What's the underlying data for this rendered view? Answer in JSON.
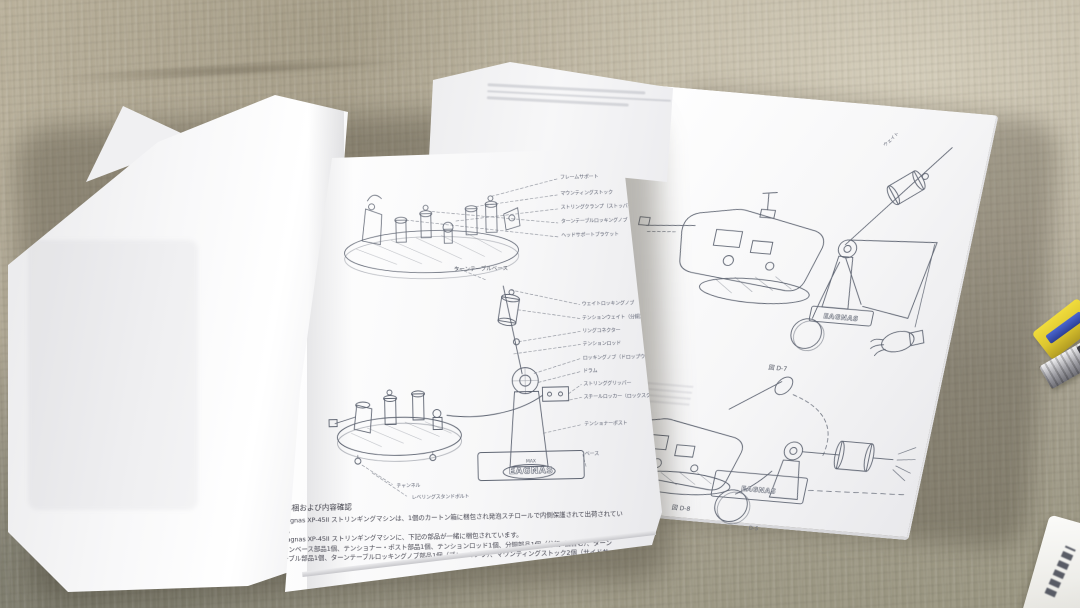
{
  "scene": {
    "type": "photo",
    "subject": "Japanese instruction manual pages for an Eagnas XP-45II stringing machine laid on a carpet",
    "colors": {
      "carpet_light": "#c6bfab",
      "carpet_mid": "#b0a996",
      "carpet_dark": "#8f8c7b",
      "paper": "#f6f6f7",
      "line_ink": "#4a5160",
      "text_ink": "#474752",
      "tool_yellow": "#e4cf35",
      "tool_blue": "#3a55c0",
      "metal_gray": "#9a9aa0"
    }
  },
  "left_page": {
    "diagram_base": {
      "caption": "ターンテーブルベース",
      "callouts": [
        "フレームサポート",
        "マウンティングストック",
        "ストリングクランプ（ストッパー付）",
        "ターンテーブルロッキングノブ",
        "ヘッドサポートブラケット"
      ]
    },
    "diagram_machine": {
      "logo": "EAGNAS",
      "logo_mark": "MAX",
      "callouts": [
        "ウェイトロッキングノブ",
        "テンションウェイト（分銅）",
        "リングコネクター",
        "テンションロッド",
        "ロッキングノブ（ドロップウェイト）",
        "ドラム",
        "ストリンググリッパー",
        "スチールロッカー（ロックスクリュー）",
        "テンショナーポスト",
        "ベース"
      ],
      "bottom_callouts": [
        "チャンネル",
        "レベリングスタンドボルト"
      ]
    },
    "section": {
      "heading": "1. 解梱および内容確認",
      "lines": [
        "Eagnas XP-45II ストリンギングマシンは、1個のカートン箱に梱包され発泡スチロールで内側保護されて出荷されてい",
        "ます。",
        "Eagnas XP-45II ストリンギングマシンに、下記の部品が一緒に梱包されています。",
        "マシンベース部品1個、テンショナー・ポスト部品1個、テンションロッド1個、分銅部品1個（分銅2個含む）、ターン",
        "テーブル部品1個、ターンテーブルロッキングノブ部品1個（ブレーキノブ）、マウンティングストック2個（サイドサ"
      ]
    }
  },
  "right_page": {
    "figure_top": {
      "caption": "図 D-7",
      "rod_label": "ウェイト",
      "logo": "EAGNAS"
    },
    "figure_bottom": {
      "caption": "図 D-8",
      "logo": "EAGNAS"
    },
    "page_number": "D-5"
  }
}
